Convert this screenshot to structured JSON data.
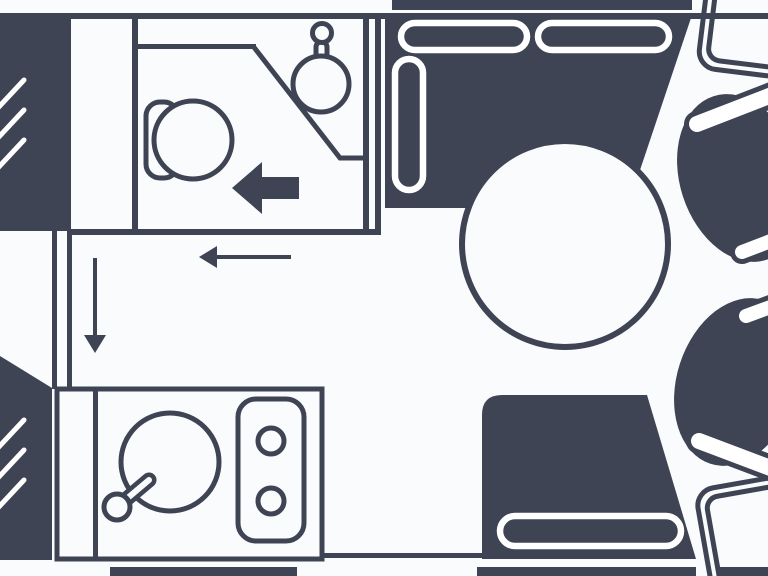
{
  "diagram": {
    "type": "floorplan",
    "subject": "caravan interior layout, top view line drawing",
    "colors": {
      "ink": "#3e4453",
      "paper": "#fafbfc",
      "cushion_outline": "#ffffff"
    },
    "rooms": {
      "washroom": {
        "fixtures": [
          "toilet",
          "corner-basin",
          "basin-tap"
        ],
        "position": "top-left"
      },
      "kitchen": {
        "fixtures": [
          "round-sink",
          "sink-tap",
          "two-burner-hob"
        ],
        "position": "bottom-left"
      },
      "lounge": {
        "fixtures": [
          "top-bench-seat",
          "bottom-bench-seat",
          "round-table",
          "swivel-chair-upper",
          "swivel-chair-lower",
          "cab-seat-top-corner",
          "cab-seat-bottom-corner"
        ],
        "position": "right"
      }
    },
    "annotations": {
      "arrows": [
        "thick-left-arrow-in-washroom",
        "thin-left-arrow-corridor",
        "thin-down-arrow-corridor"
      ],
      "window_hatches": [
        "front-wardrobe-block",
        "rear-kitchen-block"
      ]
    },
    "components": [
      "top-wall",
      "bottom-wall-segments",
      "wardrobe-block",
      "rear-block",
      "washroom-walls",
      "corridor-partition",
      "toilet",
      "corner-basin",
      "kitchen-unit",
      "sink",
      "hob",
      "dinette-sofa",
      "sofa-cushions",
      "bench-seat",
      "bench-cushion",
      "table",
      "swivel-chairs",
      "cab-seats"
    ]
  }
}
